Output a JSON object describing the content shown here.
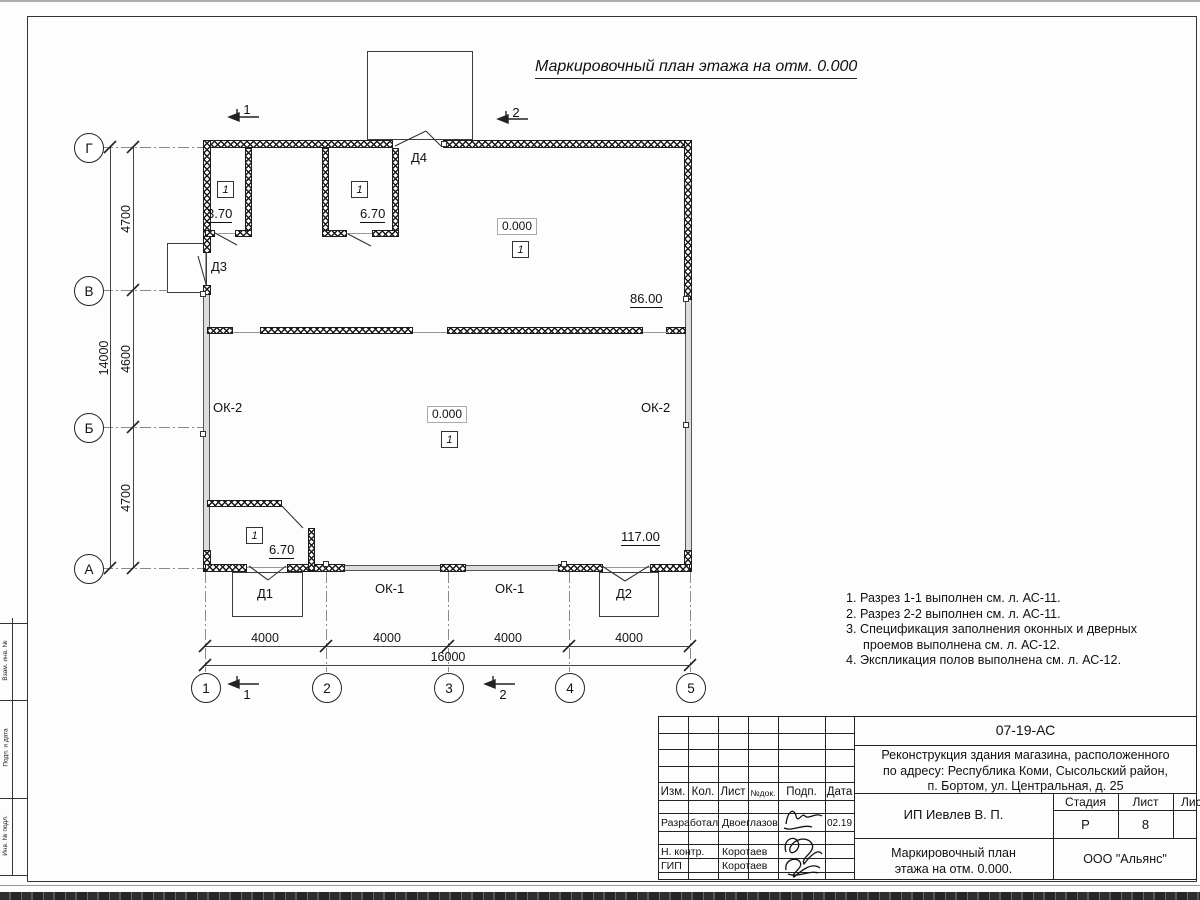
{
  "sheet_title": "Маркировочный план этажа на отм. 0.000",
  "plan": {
    "axis_letters": [
      "Г",
      "В",
      "Б",
      "А"
    ],
    "axis_numbers": [
      "1",
      "2",
      "3",
      "4",
      "5"
    ],
    "dims_vertical": [
      "4700",
      "4600",
      "4700"
    ],
    "dim_vertical_total": "14000",
    "dims_horizontal": [
      "4000",
      "4000",
      "4000",
      "4000"
    ],
    "dim_horizontal_total": "16000",
    "elevation": "0.000",
    "floor_marker": "1",
    "areas": {
      "room_top_left": "3.70",
      "room_top_mid": "6.70",
      "hall_upper": "86.00",
      "hall_main": "117.00",
      "room_bottom_left": "6.70"
    },
    "doors": {
      "d1": "Д1",
      "d2": "Д2",
      "d3": "Д3",
      "d4": "Д4"
    },
    "windows": {
      "ok1": "ОК-1",
      "ok2": "ОК-2"
    },
    "sections": [
      "1",
      "2"
    ]
  },
  "notes": [
    "1. Разрез 1-1 выполнен см. л. АС-11.",
    "2. Разрез 2-2 выполнен см. л. АС-11.",
    "3. Спецификация заполнения оконных и дверных проемов выполнена см. л. АС-12.",
    "4. Экспликация полов выполнена см. л. АС-12."
  ],
  "titleblock": {
    "doc_number": "07-19-АС",
    "project_lines": [
      "Реконструкция здания магазина, расположенного",
      "по адресу: Республика Коми, Сысольский район,",
      "п. Бортом, ул. Центральная, д. 25"
    ],
    "client": "ИП Иевлев В. П.",
    "drawing_name_lines": [
      "Маркировочный план",
      "этажа на отм. 0.000."
    ],
    "organization": "ООО \"Альянс\"",
    "stage_label": "Стадия",
    "sheet_label": "Лист",
    "sheets_label": "Листов",
    "stage_value": "Р",
    "sheet_value": "8",
    "header_columns": [
      "Изм.",
      "Кол.",
      "Лист",
      "№док.",
      "Подп.",
      "Дата"
    ],
    "signature_rows": [
      {
        "role": "Разработал",
        "name": "Двоеглазов",
        "date": "02.19"
      },
      {
        "role": "Н. контр.",
        "name": "Коротаев",
        "date": ""
      },
      {
        "role": "ГИП",
        "name": "Коротаев",
        "date": ""
      }
    ]
  },
  "margin_labels": [
    "Взам. инв. №",
    "Подп. и дата",
    "Инв. № подл."
  ]
}
